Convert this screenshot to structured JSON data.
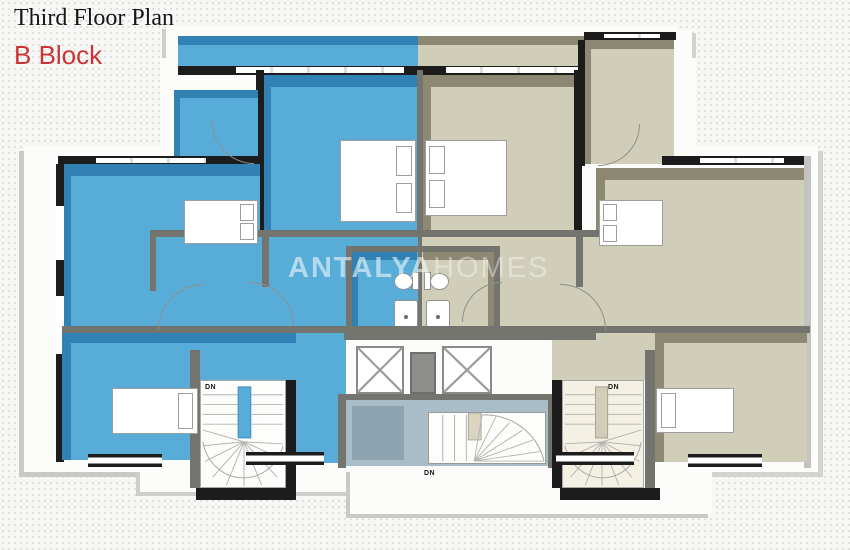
{
  "header": {
    "title": "Third Floor Plan",
    "block": "B Block"
  },
  "watermark": {
    "primary": "ANTALYA",
    "secondary": "HOMES"
  },
  "plan": {
    "stair_labels": {
      "left": "DN",
      "center": "DN",
      "right": "DN"
    }
  },
  "colors": {
    "apartment_left": "#58acd8",
    "apartment_left_shadow": "#3181b4",
    "apartment_right": "#d0cdb8",
    "apartment_right_shadow": "#8c8873",
    "stairwell_common": "#a9bdc9",
    "stairwell_common_shadow": "#8ca3b2",
    "wall_dark": "#1c1c1c",
    "wall_gray": "#74746e",
    "accent_red": "#cb3434",
    "background": "#f7f7f5",
    "plate": "#fcfcfb"
  }
}
